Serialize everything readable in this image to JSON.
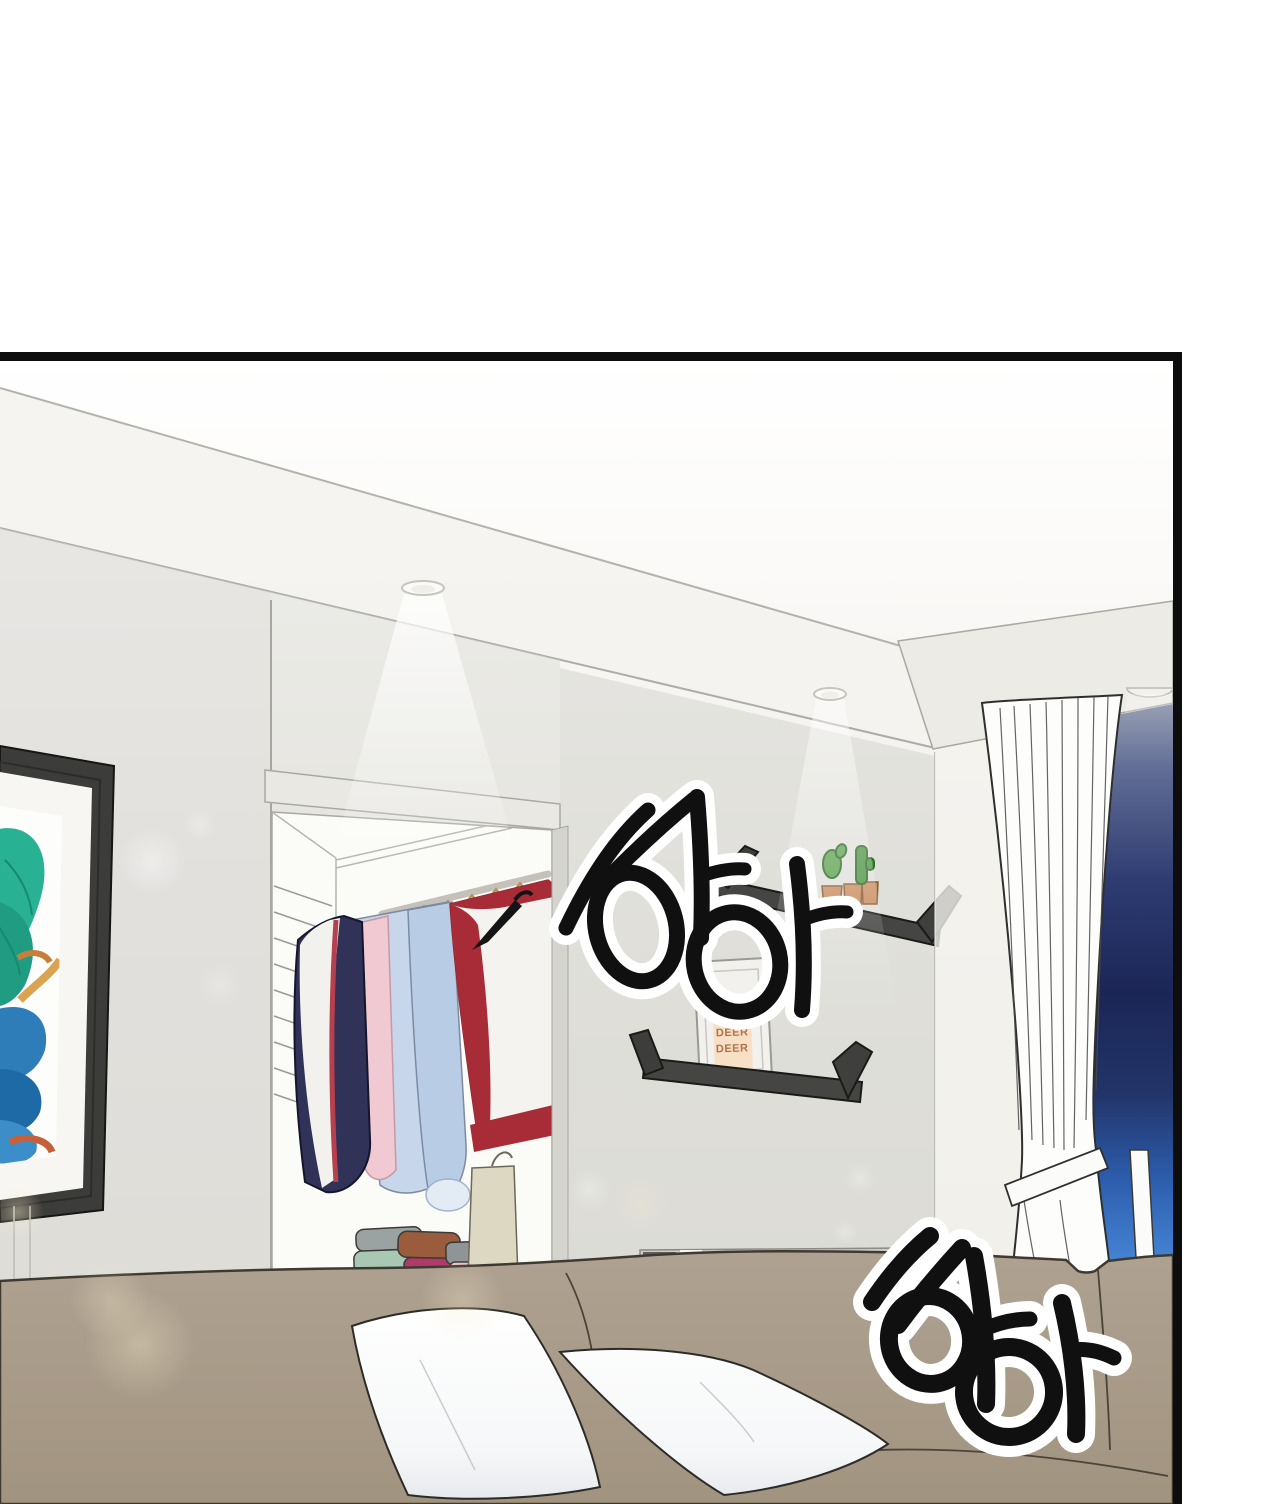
{
  "panel": {
    "kind": "webtoon comic panel",
    "scene_label": "apartment living room at night",
    "border_color": "#0d0d0d",
    "page_background": "#ffffff"
  },
  "sfx": [
    {
      "text": "하아",
      "position": "upper-middle",
      "ink": "#101010",
      "outline": "#ffffff"
    },
    {
      "text": "하아",
      "position": "lower-right",
      "ink": "#101010",
      "outline": "#ffffff"
    }
  ],
  "shelf_card": {
    "lines": [
      "DEER",
      "DEER",
      "DEER"
    ],
    "text_color": "#b0714c",
    "card_color": "#f8e0c6"
  },
  "palette": {
    "wall": "#e6e5e0",
    "wall_shaded": "#d7d6d1",
    "ceiling": "#ffffff",
    "shelf": "#454543",
    "couch": "#a89b8b",
    "pillow": "#ffffff",
    "window_night_top": "#9aa2b4",
    "window_night_deep": "#1b2656",
    "window_glow": "#4684d4",
    "curtain": "#fdfdfc",
    "art_teal": "#28b193",
    "art_blue": "#2e7cb8",
    "art_orange": "#d9a351",
    "cactus": "#5fa350",
    "pot": "#c98f62",
    "frame": "#3c3c3a"
  }
}
